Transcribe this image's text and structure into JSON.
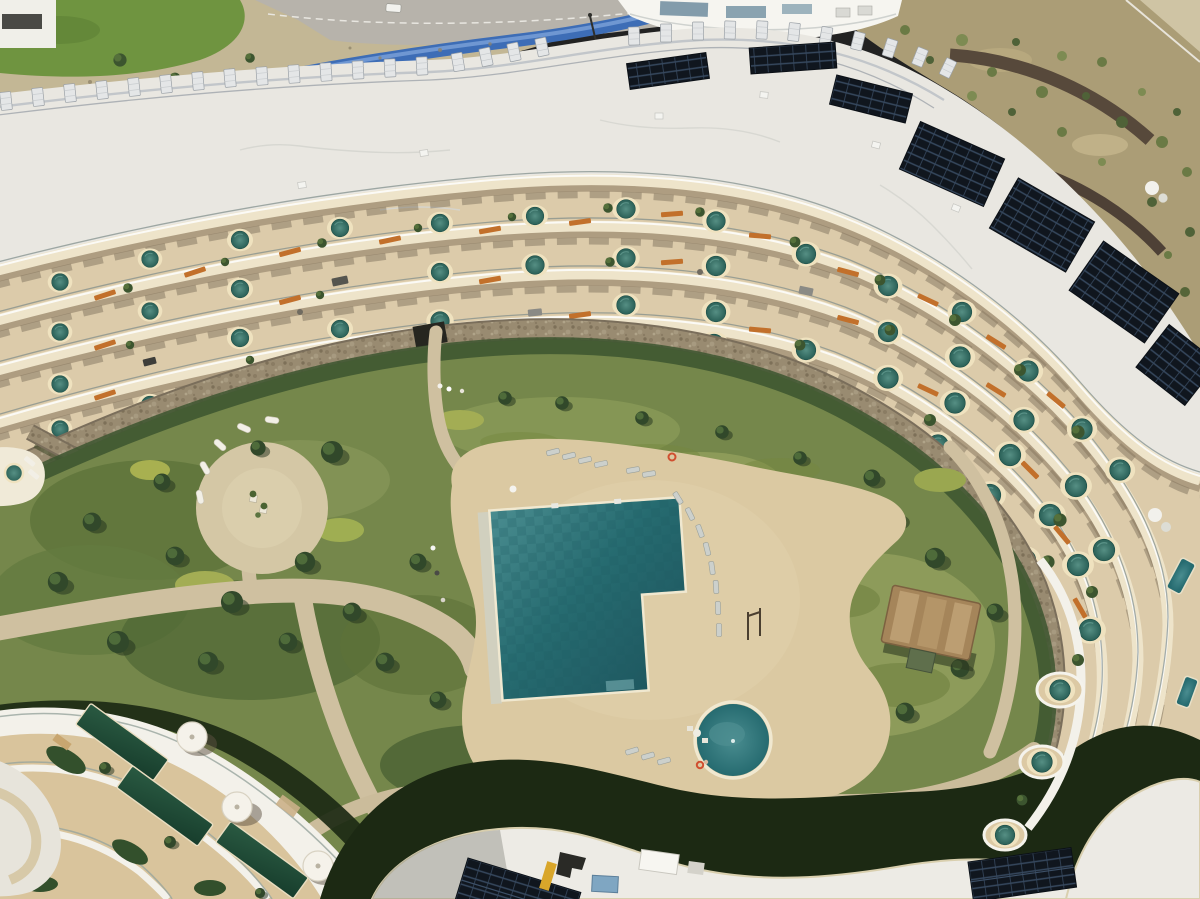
{
  "scene": {
    "type": "aerial-photograph",
    "description": "Aerial drone view of a crescent-shaped white resort apartment building with five tiered terrace floors, private round plunge pools on scalloped cream decks, corten-orange privacy screens, rooftop solar arrays, a stone retaining wall around a landscaped Mediterranean garden, a large communal swimming pool with sun loungers, a round kids pool, a lower terraced building with dark green lap pools, and wavy white roofs with photovoltaic panels",
    "time_of_day": "bright midday sun",
    "counts": {
      "terrace_floors": 5,
      "plunge_pools": 54,
      "rooftop_solar_arrays": 9,
      "roof_vent_panels": 29,
      "main_pools": 1,
      "kids_pools": 1,
      "lap_pools": 3,
      "sun_loungers": 23,
      "people": 7,
      "white_cylinders": 3,
      "lifebuoys": 2
    }
  },
  "palette": {
    "roof": "#e9e7e1",
    "roofBright": "#f6f5f0",
    "fascia": "#eee4ca",
    "deck": "#dccbaa",
    "deckLower": "#d9c49c",
    "deckShadow": "#8a7961",
    "poolRim": "#efe2bf",
    "plunge": "#35756a",
    "poolDeep": "#266b70",
    "poolLight": "#4a8d90",
    "lawn": "#8e9c5b",
    "gardenBase": "#75874b",
    "gardenDark": "#3c552f",
    "gardenLight": "#a3ad54",
    "path": "#cfc0a0",
    "plaza": "#d4c7a5",
    "stone": "#998b71",
    "stoneEdge": "#7a6e5b",
    "corten": "#c2702b",
    "solar": "#10161e",
    "shadowDark": "#1c2913",
    "blueLane": "#3d6db6",
    "road": "#b7b3ab",
    "gravel": "#c3b795",
    "hill": "#ab9d76",
    "hillWall": "#57493b",
    "whiteBand": "#f3f1ea",
    "lapPool": "#1d4a39",
    "glass": "#7e8c8a",
    "skylight": "#7fa6c2",
    "accentYellow": "#d9a62a",
    "cabana": "#a5855a",
    "treeDark": "#31482a",
    "treeLight": "#4e6b3a",
    "lounger": "#ccd0cc",
    "buoyRed": "#d04f30"
  }
}
